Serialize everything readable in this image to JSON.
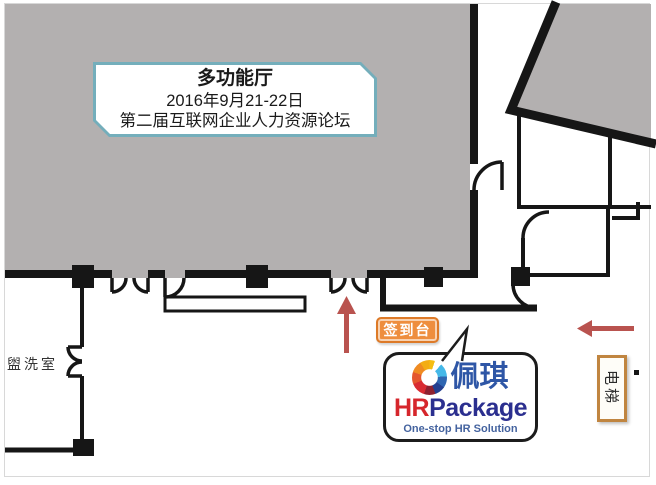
{
  "page": {
    "background": "#ffffff",
    "frame_color": "#d8d8d8"
  },
  "hall_box": {
    "title": "多功能厅",
    "date": "2016年9月21-22日",
    "event": "第二届互联网企业人力资源论坛",
    "border_color": "#74aebb"
  },
  "labels": {
    "washroom": "盥洗室",
    "checkin": "签到台",
    "elevator": "电梯"
  },
  "checkin_badge": {
    "bg_color": "#ee8e3e",
    "text_color": "#ffffff"
  },
  "logo_bubble": {
    "brand_cn": "佩琪",
    "brand_hr": "HR",
    "brand_package": "Package",
    "tagline": "One-stop HR Solution",
    "color_cn": "#2e56a6",
    "color_hr": "#d6262c",
    "color_package": "#2b2f8f",
    "color_tagline": "#44639f"
  },
  "plan": {
    "hall_fill": "#b3b0b0",
    "wall_color": "#161616",
    "arrow_color": "#b9534f"
  },
  "icons": {
    "logo_ring": "multicolor-ring-icon"
  }
}
